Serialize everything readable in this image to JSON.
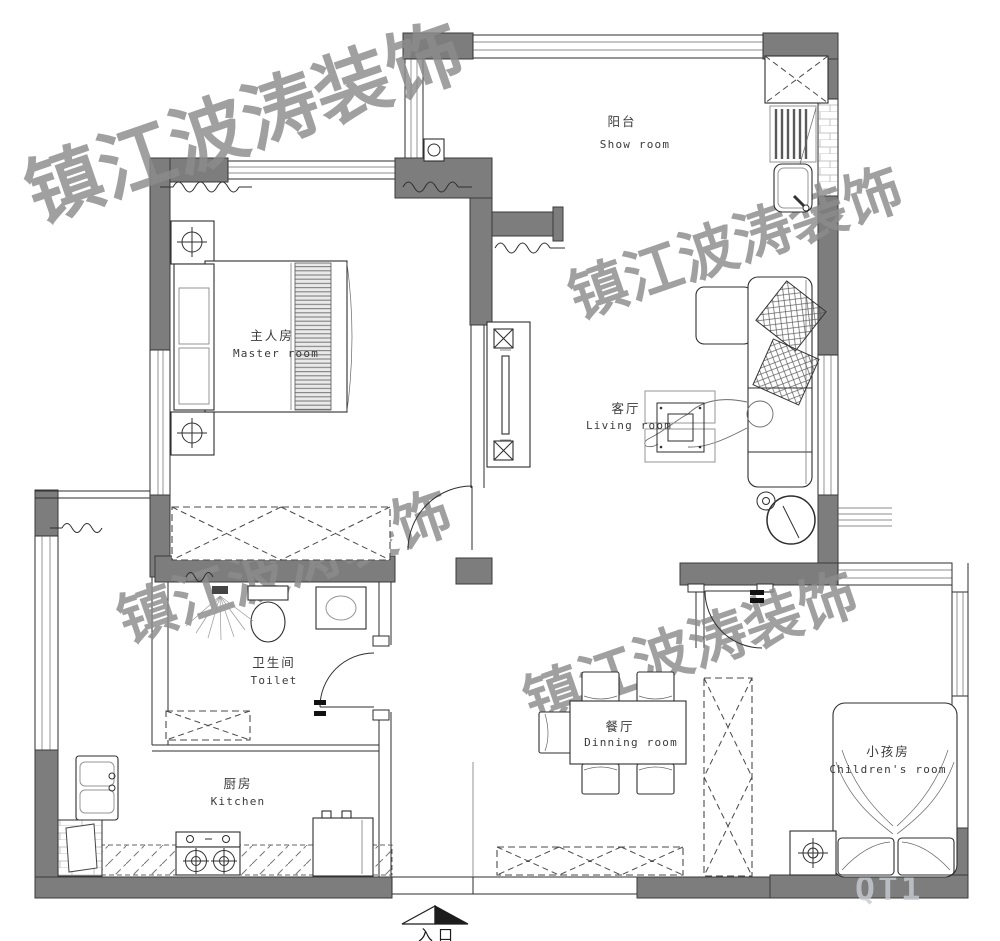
{
  "colors": {
    "background": "#ffffff",
    "wall": "#7d7d7d",
    "line": "#2e2e2e",
    "watermark": "#8c8c8c",
    "faint": "#c9ccd1"
  },
  "watermark": {
    "text": "镇江波涛装饰"
  },
  "rooms": [
    {
      "id": "balcony",
      "zh": "阳台",
      "en": "Show room"
    },
    {
      "id": "master",
      "zh": "主人房",
      "en": "Master room"
    },
    {
      "id": "living",
      "zh": "客厅",
      "en": "Living room"
    },
    {
      "id": "toilet",
      "zh": "卫生间",
      "en": "Toilet"
    },
    {
      "id": "kitchen",
      "zh": "厨房",
      "en": "Kitchen"
    },
    {
      "id": "dining",
      "zh": "餐厅",
      "en": "Dinning room"
    },
    {
      "id": "children",
      "zh": "小孩房",
      "en": "Children's room"
    }
  ],
  "entrance": {
    "label": "入口",
    "arrow_icon": "entry-direction-arrow"
  },
  "faint_logo": {
    "text": "QT1"
  }
}
